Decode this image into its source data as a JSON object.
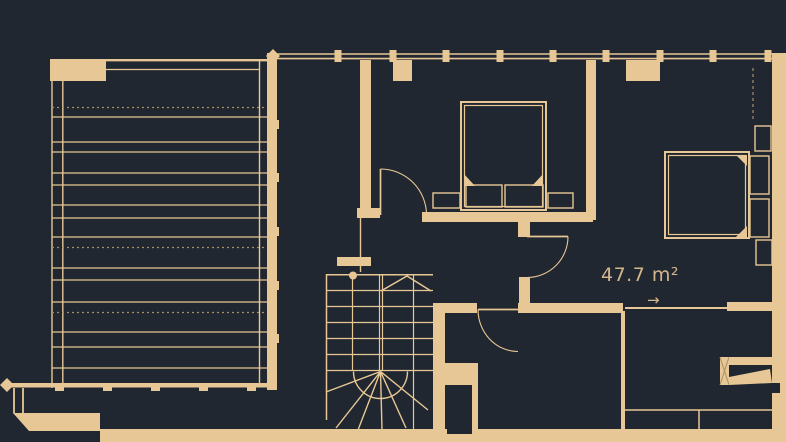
{
  "plan": {
    "area_label": "47.7 m²",
    "direction_arrow": "→"
  },
  "colors": {
    "background": "#212730",
    "wall": "#e7c795",
    "muted_line": "#a98f66",
    "label_text": "#d2b78d"
  },
  "features": [
    "terrace-deck",
    "double-bed-1",
    "double-bed-2",
    "winder-staircase",
    "entry-door",
    "interior-doors"
  ]
}
